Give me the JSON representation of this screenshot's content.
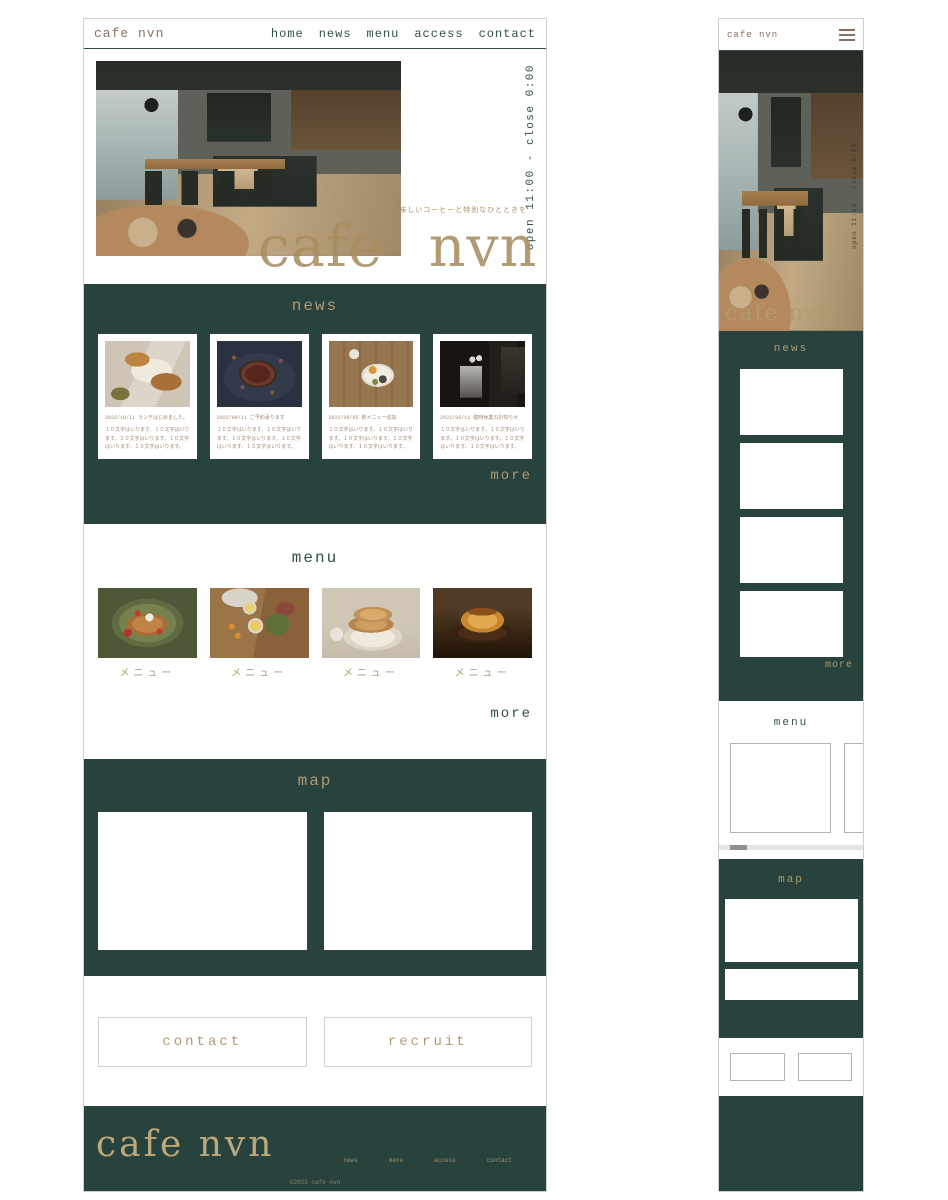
{
  "colors": {
    "dark_teal": "#28423d",
    "tan": "#b09a6e",
    "logo_brown": "#8a6f60"
  },
  "desktop": {
    "header": {
      "logo": "cafe nvn",
      "nav": [
        "home",
        "news",
        "menu",
        "access",
        "contact"
      ]
    },
    "hero": {
      "hours": "open 11:00 - close 0:00",
      "tagline": "美味しいコーヒーと特別なひとときを",
      "title_cafe": "cafe",
      "title_nvn": "nvn"
    },
    "news": {
      "title": "news",
      "more": "more",
      "items": [
        {
          "date": "2022/10/11",
          "title": "ランチはじめました。",
          "body": "１０文字はいります。１０文字はいります。１０文字はいります。１０文字はいります。１０文字はいります。"
        },
        {
          "date": "2022/09/11",
          "title": "ご予約承ります",
          "body": "１０文字はいります。１０文字はいります。１０文字はいります。１０文字はいります。１０文字はいります。"
        },
        {
          "date": "2022/09/05",
          "title": "新メニュー追加",
          "body": "１０文字はいります。１０文字はいります。１０文字はいります。１０文字はいります。１０文字はいります。"
        },
        {
          "date": "2022/08/11",
          "title": "臨時休業のお知らせ",
          "body": "１０文字はいります。１０文字はいります。１０文字はいります。１０文字はいります。１０文字はいります。"
        }
      ]
    },
    "menu": {
      "title": "menu",
      "more": "more",
      "items": [
        {
          "label": "メニュー"
        },
        {
          "label": "メニュー"
        },
        {
          "label": "メニュー"
        },
        {
          "label": "メニュー"
        }
      ]
    },
    "map": {
      "title": "map"
    },
    "cta": {
      "contact": "contact",
      "recruit": "recruit"
    },
    "footer": {
      "logo": "cafe nvn",
      "nav": [
        "news",
        "menu",
        "access",
        "contact"
      ],
      "copyright": "©2023 cafe nvn"
    }
  },
  "mobile": {
    "header": {
      "logo": "cafe nvn"
    },
    "hero": {
      "title": "cafe nvn",
      "hours": "open 11:00 - close 0:00"
    },
    "news": {
      "title": "news",
      "more": "more"
    },
    "menu": {
      "title": "menu"
    },
    "map": {
      "title": "map"
    }
  }
}
